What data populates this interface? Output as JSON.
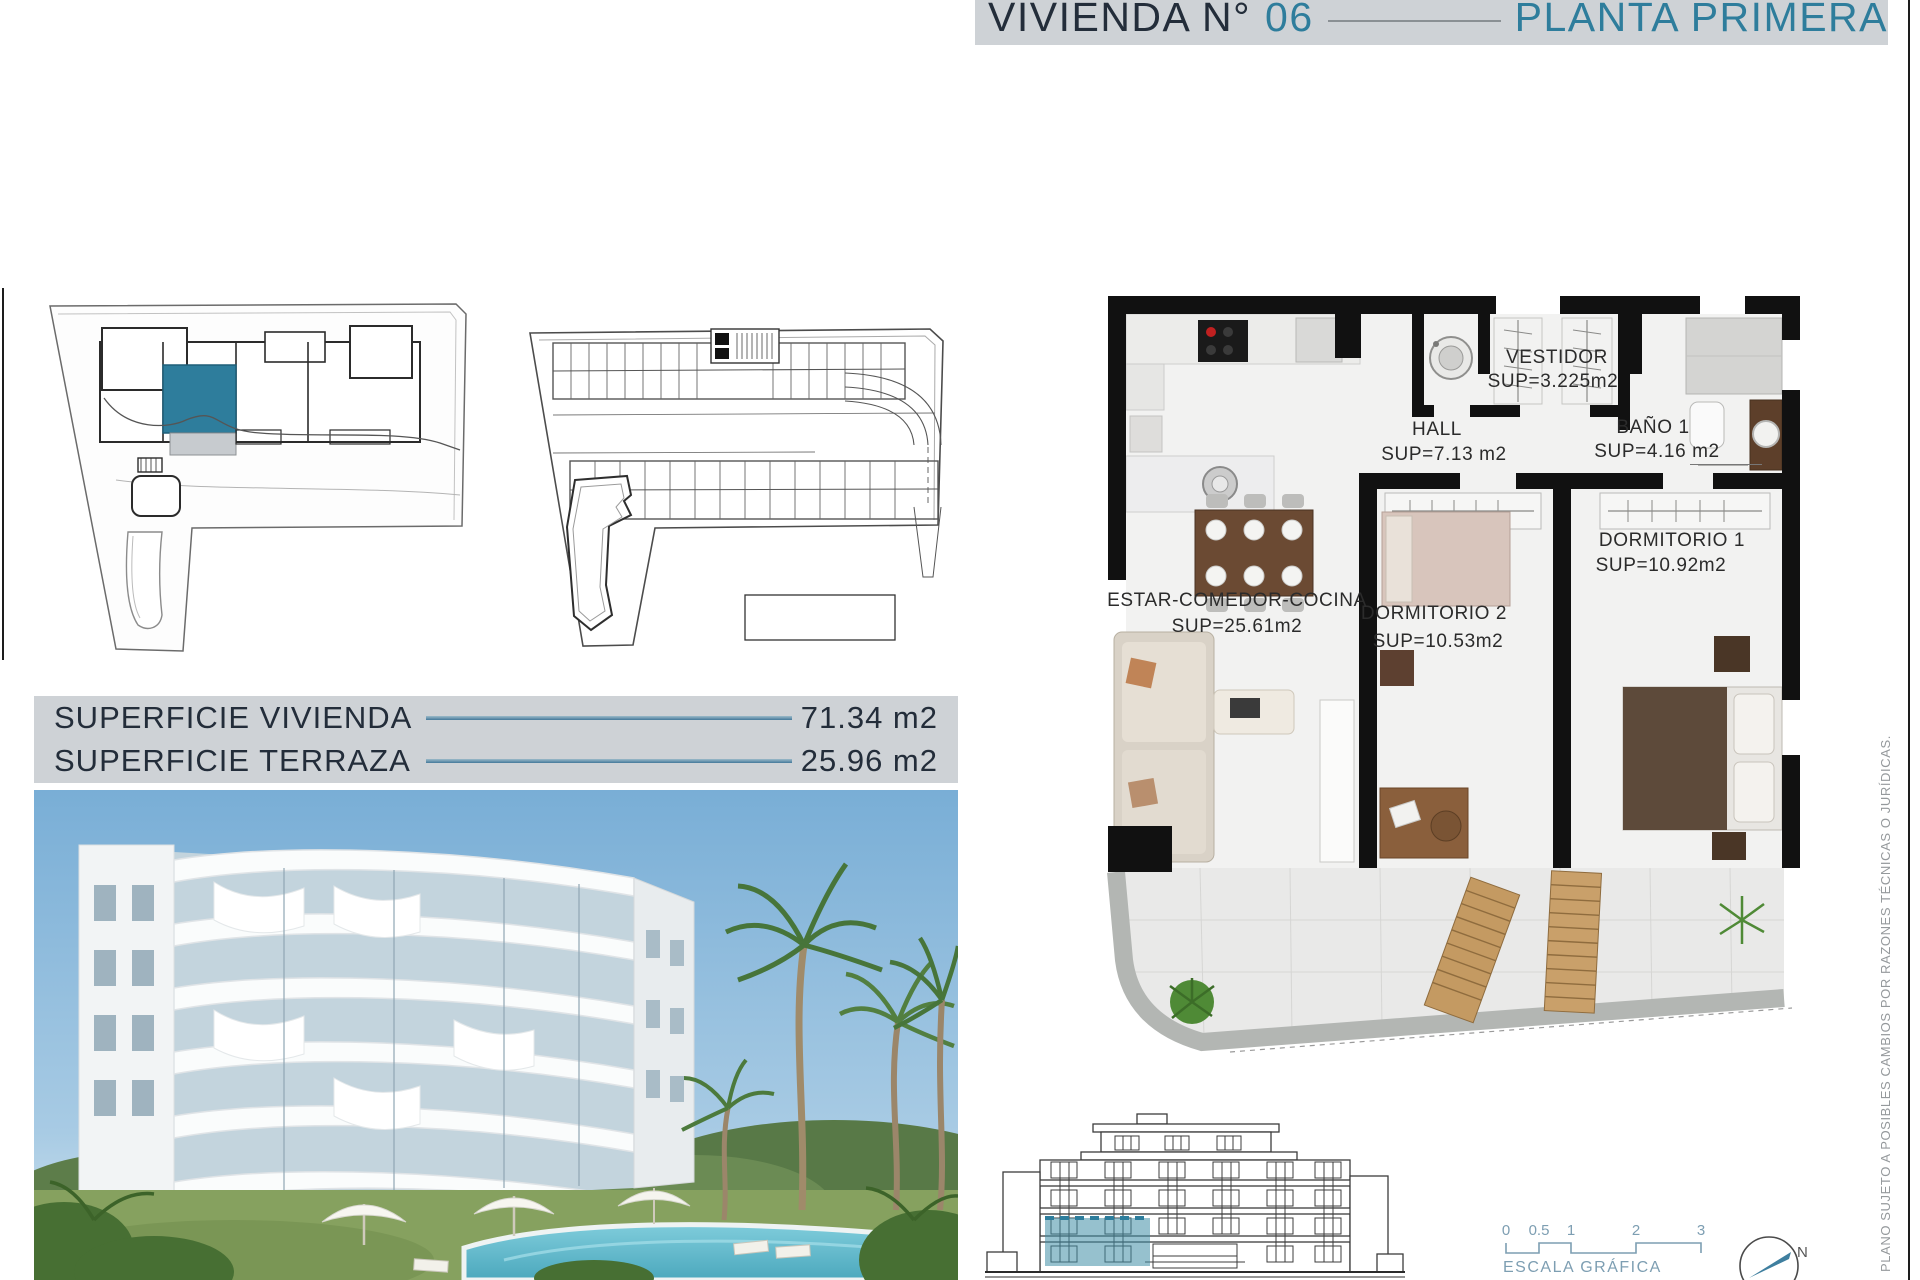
{
  "header": {
    "prefix": "VIVIENDA N°",
    "number": "06",
    "suffix": "PLANTA PRIMERA"
  },
  "surface_table": {
    "rows": [
      {
        "label": "SUPERFICIE VIVIENDA",
        "value": "71.34 m2"
      },
      {
        "label": "SUPERFICIE TERRAZA",
        "value": "25.96 m2"
      }
    ]
  },
  "floor_plan": {
    "rooms": [
      {
        "name": "ESTAR-COMEDOR-COCINA",
        "area": "SUP=25.61m2"
      },
      {
        "name": "DORMITORIO 2",
        "area": "SUP=10.53m2"
      },
      {
        "name": "DORMITORIO 1",
        "area": "SUP=10.92m2"
      },
      {
        "name": "HALL",
        "area": "SUP=7.13 m2"
      },
      {
        "name": "VESTIDOR",
        "area": "SUP=3.225m2"
      },
      {
        "name": "BAÑO 1",
        "area": "SUP=4.16 m2"
      }
    ]
  },
  "scale_bar": {
    "ticks": [
      "0",
      "0.5",
      "1",
      "2",
      "3"
    ],
    "label": "ESCALA GRÁFICA"
  },
  "compass": {
    "north_label": "N"
  },
  "disclaimer": {
    "text": "PLANO SUJETO A POSIBLES CAMBIOS POR RAZONES TÉCNICAS O JURÍDICAS."
  },
  "colors": {
    "accent_teal": "#2e7d9c",
    "header_bar": "#ced2d6",
    "dark_text": "#232d3a",
    "scale_teal": "#7d9eb2"
  }
}
